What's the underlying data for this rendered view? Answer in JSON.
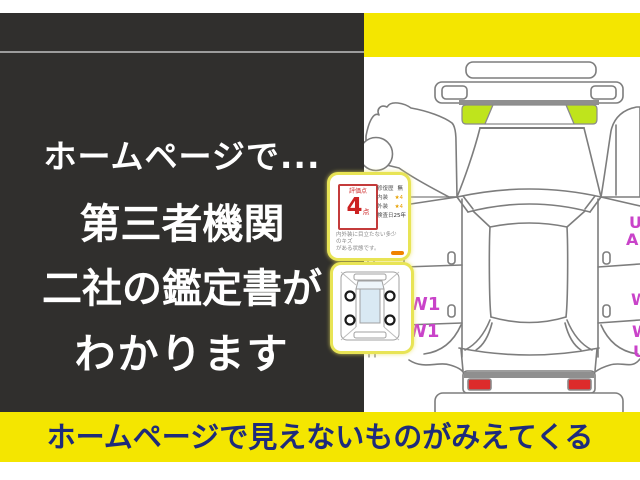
{
  "panel": {
    "line1": "ホームページで...",
    "line2": "第三者機関",
    "line3": "二社の鑑定書が",
    "line4": "わかります"
  },
  "banner": {
    "text": "ホームページで見えないものがみえてくる"
  },
  "certificate": {
    "score_label": "評価点",
    "score_value": "4",
    "score_unit": "点",
    "rows": [
      {
        "label": "修復歴",
        "value": "無"
      },
      {
        "label": "内装",
        "value": "★4"
      },
      {
        "label": "外装",
        "value": "★4"
      },
      {
        "label": "検査日",
        "value": "25年"
      }
    ],
    "note_line1": "内外装に目立たない多少のキズ",
    "note_line2": "がある状態です。"
  },
  "diagram": {
    "marks_left": [
      "W1",
      "W1"
    ],
    "marks_right_top": [
      "U",
      "A"
    ],
    "marks_right_bottom": [
      "W",
      "W",
      "U"
    ]
  },
  "colors": {
    "panel_dark": "#302f2d",
    "yellow": "#f4e600",
    "navy_text": "#1e2b7b",
    "magenta_mark": "#c943c9",
    "green_highlight": "#bfe41c",
    "tail_light_red": "#dd2b2b",
    "score_red": "#cc2222"
  }
}
